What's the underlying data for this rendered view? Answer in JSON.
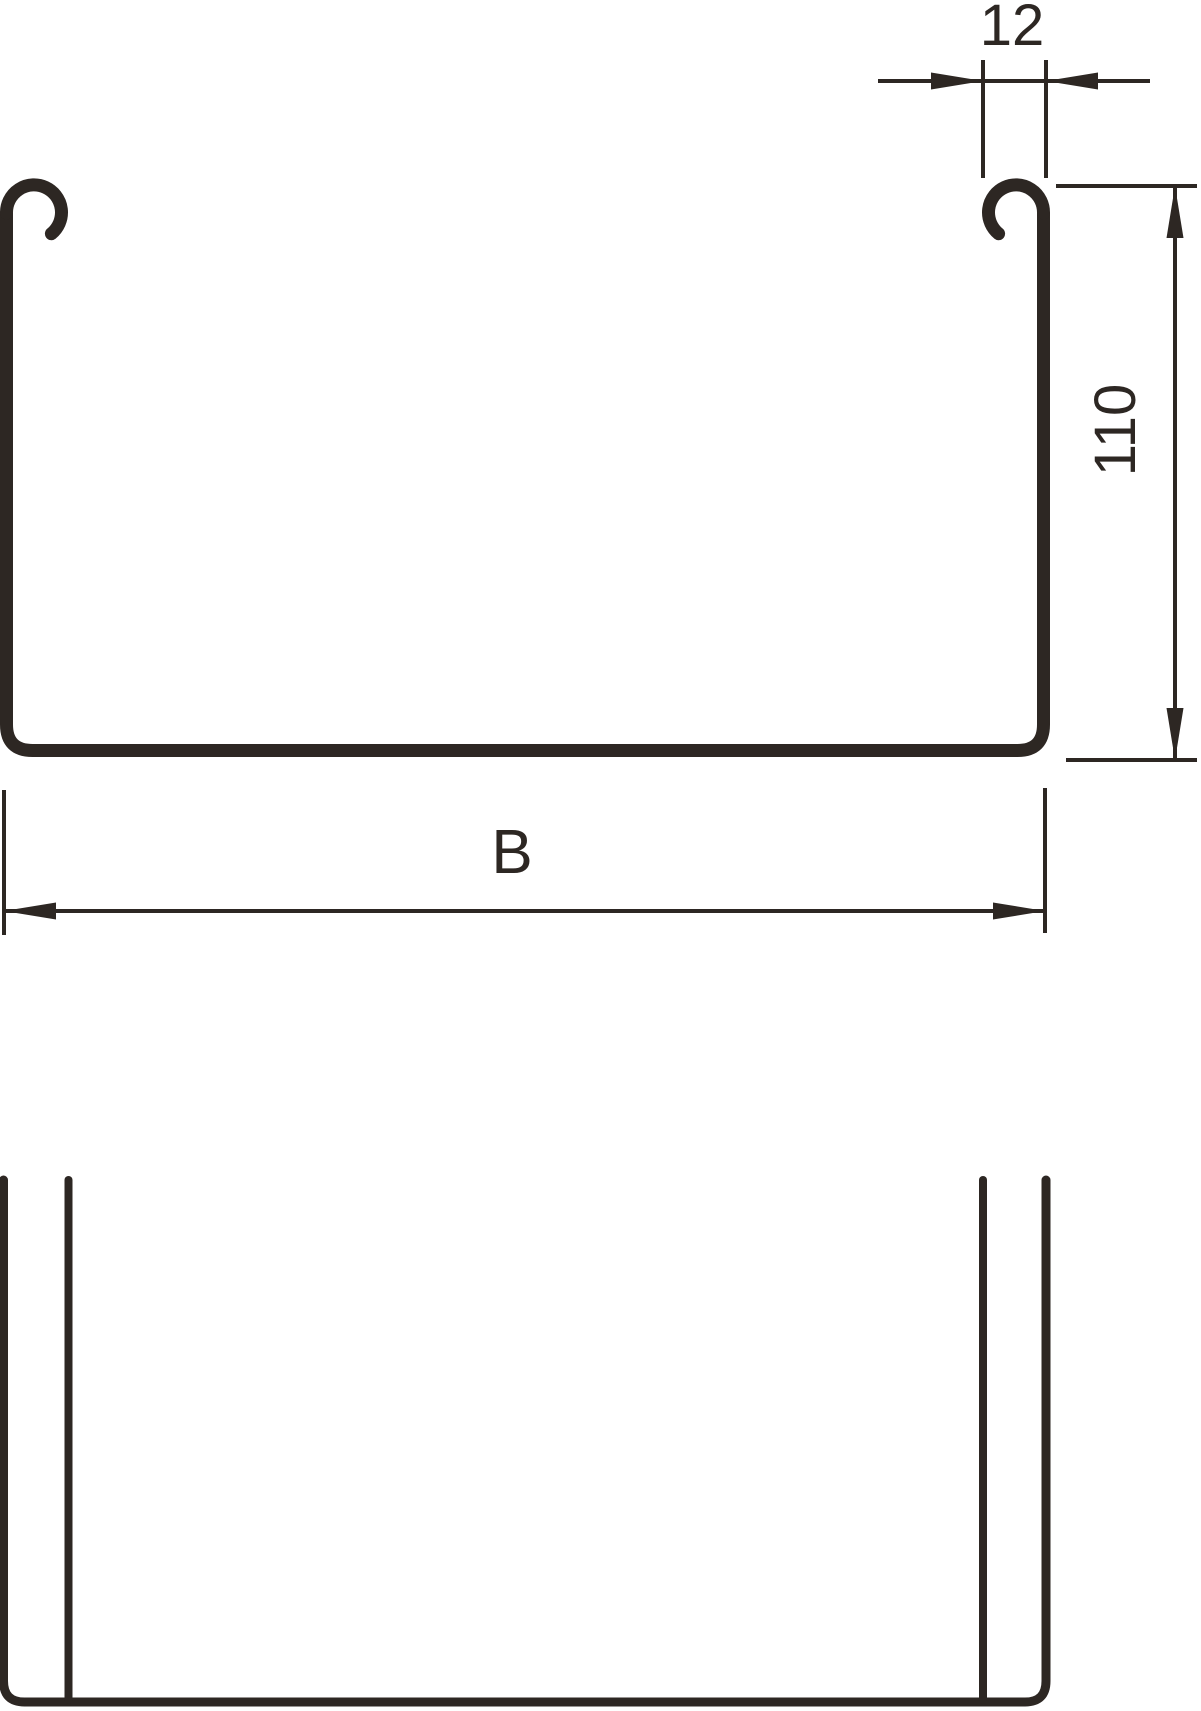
{
  "drawing": {
    "line_color": "#2d2723",
    "background_color": "#ffffff",
    "dimensions": {
      "flange": {
        "value": "12"
      },
      "height": {
        "value": "110"
      },
      "width": {
        "value": "B"
      }
    }
  }
}
